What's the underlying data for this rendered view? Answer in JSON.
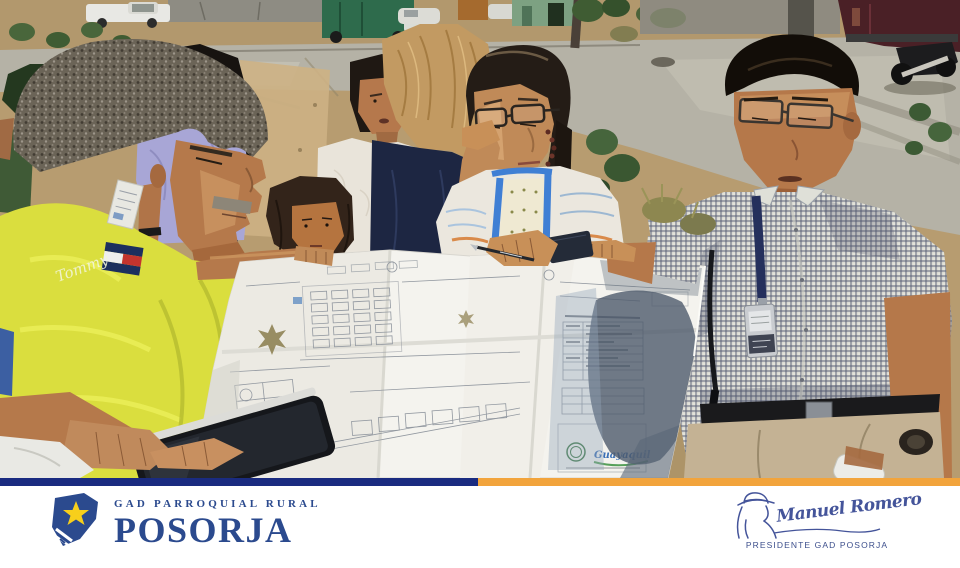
{
  "footer": {
    "brand": {
      "tagline": "GAD PARROQUIAL RURAL",
      "name": "POSORJA"
    },
    "signature": {
      "name": "Manuel Romero",
      "title": "PRESIDENTE GAD POSORJA"
    }
  },
  "photo": {
    "description": "Residents and officials of Posorja stand on a sunlit dirt road reviewing a large folded urban site plan; a man in a yellow Tommy shirt and a man in a checked shirt with an ID lanyard hold the blueprint while a woman with glasses points with a pen; vehicles, a motorcycle and dry shrubs in the background.",
    "shirt_script": "Tommy",
    "blueprint_stamp": "Guayaquil"
  },
  "colors": {
    "stripe_navy": "#1a2b80",
    "stripe_amber": "#f2a43c",
    "logo_blue": "#2b4a8e",
    "logo_star_yellow": "#f7cf1b",
    "signature_blue": "#44549a",
    "shirt_yellow": "#dade3e",
    "blueprint_paper": "#f4f3ee",
    "dirt": "#b79c70",
    "road_concrete": "#b5b2a6"
  }
}
